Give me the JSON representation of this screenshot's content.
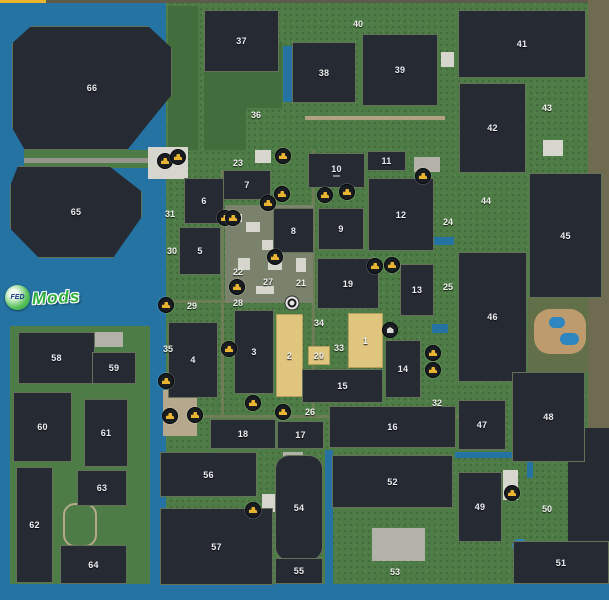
{
  "map": {
    "watermark": {
      "circle_text": "FED",
      "text": "Mods"
    },
    "colors": {
      "water": "#2473a2",
      "water2": "#2e86c0",
      "land": "#4e7c46",
      "forest": "#426d3c",
      "olive": "#62704a",
      "navy": "#262a33",
      "brown": "#6f6b51",
      "edge": "#5d5b49",
      "accent": "#e9b52f",
      "sand": "#bd9b6d",
      "sand2": "#b5a88d",
      "farmpad": "#7a826b",
      "lane": "#6d7d55",
      "road": "#96968c",
      "tanroad": "#b1a183",
      "bldg": "#d6d6cf",
      "bldg2": "#b3b2a8",
      "field_dark": "#262a33",
      "field_tan": "#dfc57d",
      "icon_glyph": "#e9b42f"
    },
    "zones": [
      {
        "name": "map-edge-top",
        "x": 0,
        "y": 0,
        "w": 609,
        "h": 3,
        "c": "edge"
      },
      {
        "name": "top-accent-strip",
        "x": 0,
        "y": 0,
        "w": 46,
        "h": 4,
        "c": "accent"
      },
      {
        "name": "water-left",
        "x": 0,
        "y": 3,
        "w": 166,
        "h": 597,
        "c": "water"
      },
      {
        "name": "water-bottom",
        "x": 0,
        "y": 584,
        "w": 609,
        "h": 16,
        "c": "water"
      },
      {
        "name": "shore-band",
        "x": 24,
        "y": 150,
        "w": 154,
        "h": 18,
        "c": "land"
      },
      {
        "name": "land-southwest",
        "x": 10,
        "y": 326,
        "w": 140,
        "h": 258,
        "c": "land"
      },
      {
        "name": "forest-west",
        "x": 168,
        "y": 6,
        "w": 30,
        "h": 144,
        "c": "forest"
      },
      {
        "name": "forest-36",
        "x": 204,
        "y": 66,
        "w": 42,
        "h": 84,
        "c": "forest"
      },
      {
        "name": "forest-38",
        "x": 246,
        "y": 42,
        "w": 36,
        "h": 66,
        "c": "forest"
      },
      {
        "name": "brown-margin",
        "x": 588,
        "y": 0,
        "w": 21,
        "h": 430,
        "c": "brown"
      },
      {
        "name": "olive-east",
        "x": 528,
        "y": 298,
        "w": 60,
        "h": 74,
        "c": "olive"
      },
      {
        "name": "navy-corner",
        "x": 568,
        "y": 428,
        "w": 41,
        "h": 114,
        "c": "navy"
      },
      {
        "name": "road-shore",
        "x": 24,
        "y": 158,
        "w": 154,
        "h": 5,
        "c": "road"
      },
      {
        "name": "lane-vertical-1",
        "x": 221,
        "y": 170,
        "w": 3,
        "h": 246,
        "c": "lane"
      },
      {
        "name": "lane-vertical-2",
        "x": 312,
        "y": 150,
        "w": 3,
        "h": 268,
        "c": "lane"
      },
      {
        "name": "lane-horizontal-1",
        "x": 162,
        "y": 415,
        "w": 296,
        "h": 3,
        "c": "lane"
      },
      {
        "name": "lane-horizontal-2",
        "x": 164,
        "y": 300,
        "w": 148,
        "h": 3,
        "c": "lane"
      },
      {
        "name": "road-north",
        "x": 305,
        "y": 116,
        "w": 140,
        "h": 4,
        "c": "tanroad"
      },
      {
        "name": "farmyard",
        "x": 225,
        "y": 205,
        "w": 88,
        "h": 98,
        "c": "farmpad"
      },
      {
        "name": "building",
        "x": 148,
        "y": 147,
        "w": 40,
        "h": 32,
        "c": "bldg"
      },
      {
        "name": "building",
        "x": 255,
        "y": 150,
        "w": 16,
        "h": 13,
        "c": "bldg"
      },
      {
        "name": "building",
        "x": 340,
        "y": 154,
        "w": 24,
        "h": 20,
        "c": "bldg2"
      },
      {
        "name": "building",
        "x": 414,
        "y": 157,
        "w": 26,
        "h": 15,
        "c": "bldg2"
      },
      {
        "name": "building",
        "x": 441,
        "y": 52,
        "w": 13,
        "h": 15,
        "c": "bldg"
      },
      {
        "name": "building",
        "x": 93,
        "y": 332,
        "w": 30,
        "h": 15,
        "c": "bldg2"
      },
      {
        "name": "building",
        "x": 372,
        "y": 528,
        "w": 53,
        "h": 33,
        "c": "bldg2"
      },
      {
        "name": "building",
        "x": 262,
        "y": 494,
        "w": 16,
        "h": 18,
        "c": "bldg"
      },
      {
        "name": "building",
        "x": 283,
        "y": 452,
        "w": 20,
        "h": 15,
        "c": "bldg2"
      },
      {
        "name": "building",
        "x": 503,
        "y": 470,
        "w": 15,
        "h": 30,
        "c": "bldg"
      },
      {
        "name": "building",
        "x": 543,
        "y": 140,
        "w": 20,
        "h": 16,
        "c": "bldg"
      },
      {
        "name": "building",
        "x": 355,
        "y": 262,
        "w": 22,
        "h": 16,
        "c": "bldg2"
      },
      {
        "name": "farm-building",
        "x": 230,
        "y": 214,
        "w": 12,
        "h": 8,
        "c": "bldg"
      },
      {
        "name": "farm-building",
        "x": 246,
        "y": 222,
        "w": 14,
        "h": 10,
        "c": "bldg"
      },
      {
        "name": "farm-building",
        "x": 262,
        "y": 240,
        "w": 16,
        "h": 10,
        "c": "bldg"
      },
      {
        "name": "farm-building",
        "x": 238,
        "y": 258,
        "w": 12,
        "h": 12,
        "c": "bldg"
      },
      {
        "name": "farm-building",
        "x": 268,
        "y": 262,
        "w": 14,
        "h": 8,
        "c": "bldg"
      },
      {
        "name": "farm-building",
        "x": 292,
        "y": 212,
        "w": 12,
        "h": 10,
        "c": "bldg"
      },
      {
        "name": "farm-building",
        "x": 296,
        "y": 258,
        "w": 10,
        "h": 14,
        "c": "bldg"
      },
      {
        "name": "farm-building",
        "x": 256,
        "y": 286,
        "w": 18,
        "h": 8,
        "c": "bldg"
      },
      {
        "name": "campground",
        "x": 163,
        "y": 390,
        "w": 34,
        "h": 46,
        "c": "sand2"
      },
      {
        "name": "race-track",
        "x": 63,
        "y": 503,
        "w": 30,
        "h": 40,
        "ring": true,
        "r": 12
      },
      {
        "name": "beach",
        "x": 534,
        "y": 309,
        "w": 52,
        "h": 45,
        "c": "sand",
        "r": 16
      },
      {
        "name": "water-canal",
        "x": 455,
        "y": 452,
        "w": 78,
        "h": 6,
        "c": "water"
      },
      {
        "name": "water-canal",
        "x": 527,
        "y": 452,
        "w": 6,
        "h": 26,
        "c": "water"
      },
      {
        "name": "pond",
        "x": 483,
        "y": 279,
        "w": 11,
        "h": 13,
        "c": "water",
        "r": 6
      },
      {
        "name": "water-inlet",
        "x": 434,
        "y": 237,
        "w": 20,
        "h": 8,
        "c": "water"
      },
      {
        "name": "water-inlet",
        "x": 432,
        "y": 324,
        "w": 16,
        "h": 9,
        "c": "water"
      },
      {
        "name": "beach-pond",
        "x": 549,
        "y": 317,
        "w": 16,
        "h": 11,
        "c": "water2",
        "r": 6
      },
      {
        "name": "beach-pond",
        "x": 560,
        "y": 333,
        "w": 19,
        "h": 12,
        "c": "water2",
        "r": 6
      },
      {
        "name": "pond",
        "x": 512,
        "y": 539,
        "w": 16,
        "h": 14,
        "c": "water2",
        "r": 8
      },
      {
        "name": "water-strip",
        "x": 325,
        "y": 450,
        "w": 8,
        "h": 134,
        "c": "water"
      },
      {
        "name": "water-strip",
        "x": 283,
        "y": 46,
        "w": 9,
        "h": 56,
        "c": "water"
      }
    ],
    "fields": [
      {
        "n": "1",
        "x": 348,
        "y": 313,
        "w": 35,
        "h": 55,
        "kind": "tan"
      },
      {
        "n": "2",
        "x": 276,
        "y": 314,
        "w": 27,
        "h": 83,
        "kind": "tan"
      },
      {
        "n": "3",
        "x": 234,
        "y": 310,
        "w": 40,
        "h": 84
      },
      {
        "n": "4",
        "x": 168,
        "y": 322,
        "w": 50,
        "h": 76
      },
      {
        "n": "5",
        "x": 179,
        "y": 227,
        "w": 42,
        "h": 48
      },
      {
        "n": "6",
        "x": 184,
        "y": 178,
        "w": 40,
        "h": 46
      },
      {
        "n": "7",
        "x": 223,
        "y": 170,
        "w": 48,
        "h": 30
      },
      {
        "n": "8",
        "x": 273,
        "y": 208,
        "w": 41,
        "h": 45
      },
      {
        "n": "9",
        "x": 318,
        "y": 208,
        "w": 46,
        "h": 42
      },
      {
        "n": "10",
        "x": 308,
        "y": 153,
        "w": 57,
        "h": 35,
        "sub": true
      },
      {
        "n": "11",
        "x": 367,
        "y": 151,
        "w": 39,
        "h": 20
      },
      {
        "n": "12",
        "x": 368,
        "y": 178,
        "w": 66,
        "h": 73
      },
      {
        "n": "13",
        "x": 400,
        "y": 264,
        "w": 34,
        "h": 52
      },
      {
        "n": "14",
        "x": 385,
        "y": 340,
        "w": 36,
        "h": 58
      },
      {
        "n": "15",
        "x": 302,
        "y": 369,
        "w": 81,
        "h": 34
      },
      {
        "n": "16",
        "x": 329,
        "y": 406,
        "w": 127,
        "h": 42
      },
      {
        "n": "17",
        "x": 277,
        "y": 421,
        "w": 47,
        "h": 28
      },
      {
        "n": "18",
        "x": 210,
        "y": 419,
        "w": 66,
        "h": 30
      },
      {
        "n": "19",
        "x": 317,
        "y": 258,
        "w": 62,
        "h": 51
      },
      {
        "n": "20",
        "x": 308,
        "y": 346,
        "w": 22,
        "h": 19,
        "kind": "tan"
      },
      {
        "n": "37",
        "x": 204,
        "y": 10,
        "w": 75,
        "h": 62
      },
      {
        "n": "38",
        "x": 292,
        "y": 42,
        "w": 64,
        "h": 61
      },
      {
        "n": "39",
        "x": 362,
        "y": 34,
        "w": 76,
        "h": 72
      },
      {
        "n": "41",
        "x": 458,
        "y": 10,
        "w": 128,
        "h": 68
      },
      {
        "n": "42",
        "x": 459,
        "y": 83,
        "w": 67,
        "h": 90
      },
      {
        "n": "45",
        "x": 529,
        "y": 173,
        "w": 73,
        "h": 125
      },
      {
        "n": "46",
        "x": 458,
        "y": 252,
        "w": 69,
        "h": 130
      },
      {
        "n": "47",
        "x": 458,
        "y": 400,
        "w": 48,
        "h": 50
      },
      {
        "n": "48",
        "x": 512,
        "y": 372,
        "w": 73,
        "h": 90
      },
      {
        "n": "49",
        "x": 458,
        "y": 472,
        "w": 44,
        "h": 70
      },
      {
        "n": "51",
        "x": 513,
        "y": 541,
        "w": 96,
        "h": 43
      },
      {
        "n": "52",
        "x": 332,
        "y": 455,
        "w": 121,
        "h": 53
      },
      {
        "n": "54",
        "x": 275,
        "y": 455,
        "w": 48,
        "h": 106,
        "r": 14
      },
      {
        "n": "55",
        "x": 275,
        "y": 558,
        "w": 48,
        "h": 26
      },
      {
        "n": "56",
        "x": 160,
        "y": 452,
        "w": 97,
        "h": 45
      },
      {
        "n": "57",
        "x": 160,
        "y": 508,
        "w": 113,
        "h": 77
      },
      {
        "n": "58",
        "x": 18,
        "y": 332,
        "w": 77,
        "h": 52
      },
      {
        "n": "59",
        "x": 92,
        "y": 352,
        "w": 44,
        "h": 32
      },
      {
        "n": "60",
        "x": 13,
        "y": 392,
        "w": 59,
        "h": 70
      },
      {
        "n": "61",
        "x": 84,
        "y": 399,
        "w": 44,
        "h": 68
      },
      {
        "n": "62",
        "x": 16,
        "y": 467,
        "w": 37,
        "h": 116
      },
      {
        "n": "63",
        "x": 77,
        "y": 470,
        "w": 50,
        "h": 36
      },
      {
        "n": "64",
        "x": 60,
        "y": 545,
        "w": 67,
        "h": 39
      },
      {
        "n": "65",
        "x": 10,
        "y": 166,
        "w": 132,
        "h": 92,
        "clip": "oct1"
      },
      {
        "n": "66",
        "x": 12,
        "y": 26,
        "w": 160,
        "h": 124,
        "clip": "oct2"
      }
    ],
    "labels": [
      {
        "n": "21",
        "x": 301,
        "y": 283
      },
      {
        "n": "22",
        "x": 238,
        "y": 272
      },
      {
        "n": "23",
        "x": 238,
        "y": 163
      },
      {
        "n": "24",
        "x": 448,
        "y": 222
      },
      {
        "n": "25",
        "x": 448,
        "y": 287
      },
      {
        "n": "26",
        "x": 310,
        "y": 412
      },
      {
        "n": "27",
        "x": 268,
        "y": 282
      },
      {
        "n": "28",
        "x": 238,
        "y": 303
      },
      {
        "n": "29",
        "x": 192,
        "y": 306
      },
      {
        "n": "30",
        "x": 172,
        "y": 251
      },
      {
        "n": "31",
        "x": 170,
        "y": 214
      },
      {
        "n": "32",
        "x": 437,
        "y": 403
      },
      {
        "n": "33",
        "x": 339,
        "y": 348
      },
      {
        "n": "34",
        "x": 319,
        "y": 323
      },
      {
        "n": "35",
        "x": 168,
        "y": 349
      },
      {
        "n": "36",
        "x": 256,
        "y": 115
      },
      {
        "n": "40",
        "x": 358,
        "y": 24
      },
      {
        "n": "43",
        "x": 547,
        "y": 108
      },
      {
        "n": "44",
        "x": 486,
        "y": 201
      },
      {
        "n": "50",
        "x": 547,
        "y": 509
      },
      {
        "n": "53",
        "x": 395,
        "y": 572
      }
    ],
    "icons": [
      {
        "type": "sale",
        "x": 165,
        "y": 161
      },
      {
        "type": "sale",
        "x": 178,
        "y": 157
      },
      {
        "type": "sale",
        "x": 283,
        "y": 156
      },
      {
        "type": "sale",
        "x": 282,
        "y": 194
      },
      {
        "type": "sale",
        "x": 268,
        "y": 203
      },
      {
        "type": "sale",
        "x": 225,
        "y": 218
      },
      {
        "type": "sale",
        "x": 233,
        "y": 218
      },
      {
        "type": "sale",
        "x": 275,
        "y": 257
      },
      {
        "type": "sale",
        "x": 325,
        "y": 195
      },
      {
        "type": "sale",
        "x": 347,
        "y": 192
      },
      {
        "type": "sale",
        "x": 423,
        "y": 176
      },
      {
        "type": "sale",
        "x": 375,
        "y": 266
      },
      {
        "type": "sale",
        "x": 392,
        "y": 265
      },
      {
        "type": "sale",
        "x": 237,
        "y": 287
      },
      {
        "type": "sale",
        "x": 166,
        "y": 305
      },
      {
        "type": "shop",
        "x": 292,
        "y": 303
      },
      {
        "type": "poi",
        "x": 390,
        "y": 330
      },
      {
        "type": "sale",
        "x": 433,
        "y": 353
      },
      {
        "type": "sale",
        "x": 433,
        "y": 370
      },
      {
        "type": "sale",
        "x": 229,
        "y": 349
      },
      {
        "type": "sale",
        "x": 166,
        "y": 381
      },
      {
        "type": "sale",
        "x": 170,
        "y": 416
      },
      {
        "type": "sale",
        "x": 195,
        "y": 415
      },
      {
        "type": "sale",
        "x": 253,
        "y": 403
      },
      {
        "type": "sale",
        "x": 283,
        "y": 412
      },
      {
        "type": "sale",
        "x": 253,
        "y": 510
      },
      {
        "type": "sale",
        "x": 512,
        "y": 493
      }
    ]
  }
}
